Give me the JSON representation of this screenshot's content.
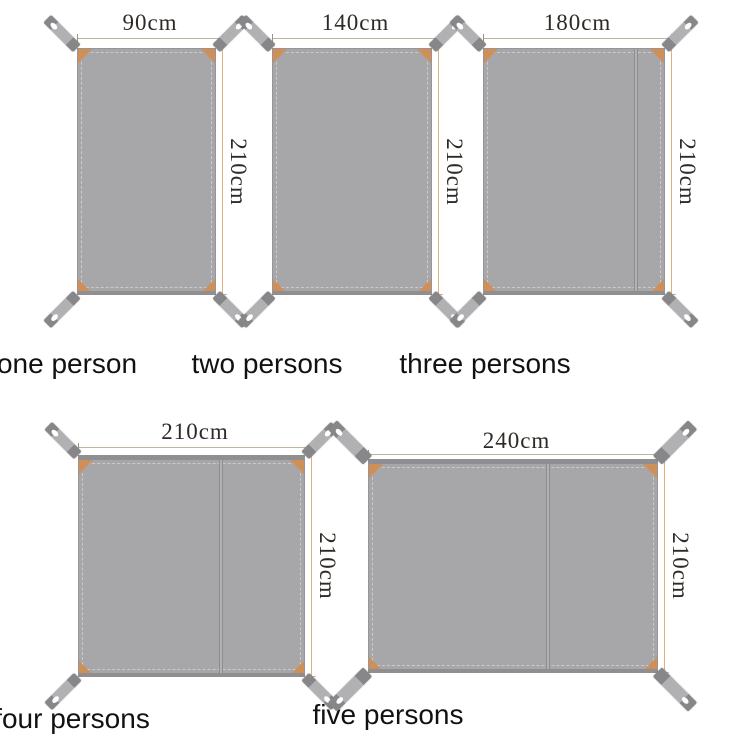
{
  "diagram": {
    "type": "product-size-chart",
    "unit": "cm",
    "common_height": "210cm"
  },
  "tarps": [
    {
      "label": "one person",
      "width_label": "90cm",
      "height_label": "210cm"
    },
    {
      "label": "two persons",
      "width_label": "140cm",
      "height_label": "210cm"
    },
    {
      "label": "three persons",
      "width_label": "180cm",
      "height_label": "210cm"
    },
    {
      "label": "four persons",
      "width_label": "210cm",
      "height_label": "210cm"
    },
    {
      "label": "five persons",
      "width_label": "240cm",
      "height_label": "210cm"
    }
  ],
  "colors": {
    "background": "#ffffff",
    "fabric": "#a7a7a9",
    "fabric_edge": "#96969a",
    "hem": "#8f8f92",
    "stitch": "#cacacc",
    "seam_edge": "#8d8d90",
    "seam_fill": "#b2b2b4",
    "strap_dark": "#87878a",
    "strap_light": "#b1b1b3",
    "grommet": "#ffffff",
    "corner_patch": "#cf8f58",
    "dim_line": "#bfb49f",
    "dim_tick": "#9e937f",
    "ext_line": "#ddb183",
    "dim_text": "#2e2b27",
    "label_text": "#111111"
  }
}
